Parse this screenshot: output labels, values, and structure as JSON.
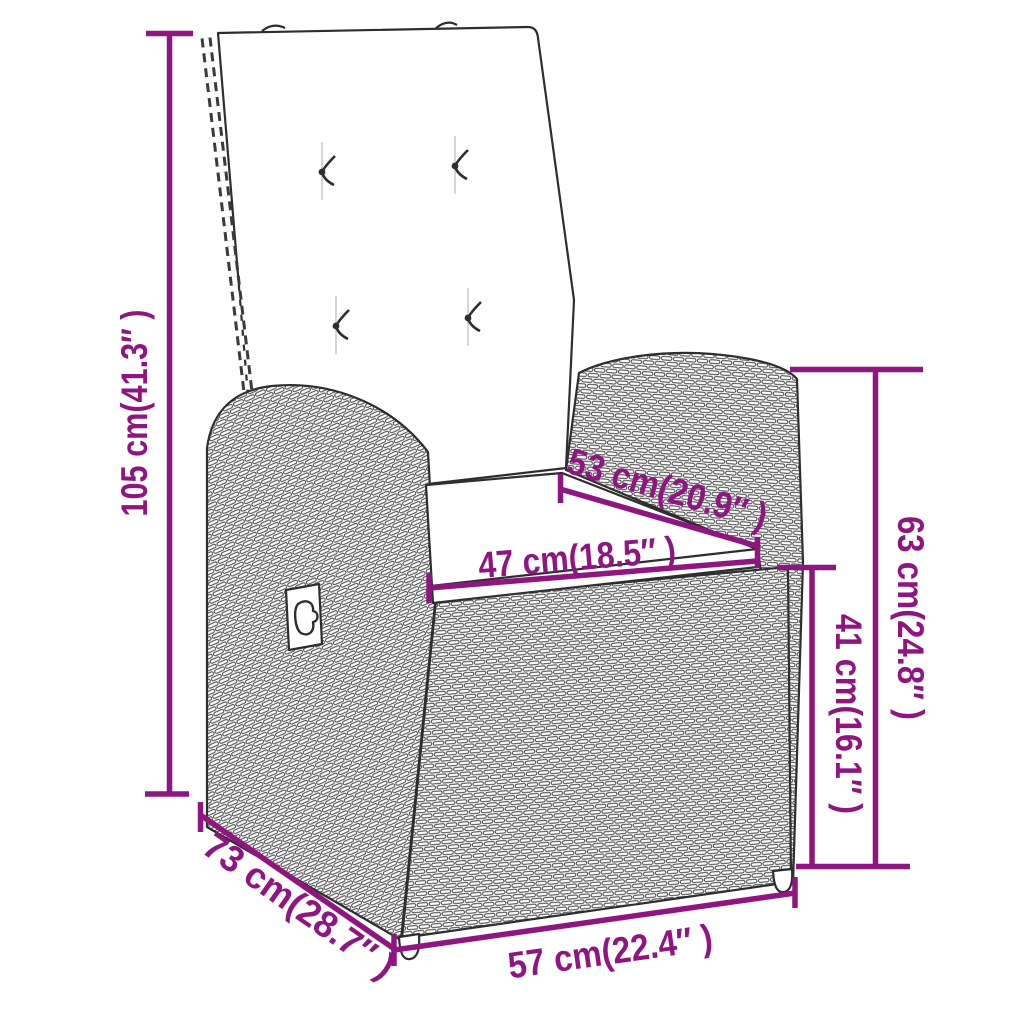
{
  "diagram": {
    "accent_color": "#8F1680",
    "art_color": "#2e2e2e",
    "background_color": "#FFFFFF",
    "subject": "reclining-garden-chair-with-cushions-dimension-drawing",
    "measurements": {
      "overall_height": "105 cm(41.3″ )",
      "overall_depth": "73 cm(28.7″ )",
      "overall_width": "57 cm(22.4″ )",
      "seat_width": "47 cm(18.5″ )",
      "seat_depth": "53 cm(20.9″ )",
      "armrest_height": "63 cm(24.8″ )",
      "seat_height": "41 cm(16.1″ )"
    }
  }
}
